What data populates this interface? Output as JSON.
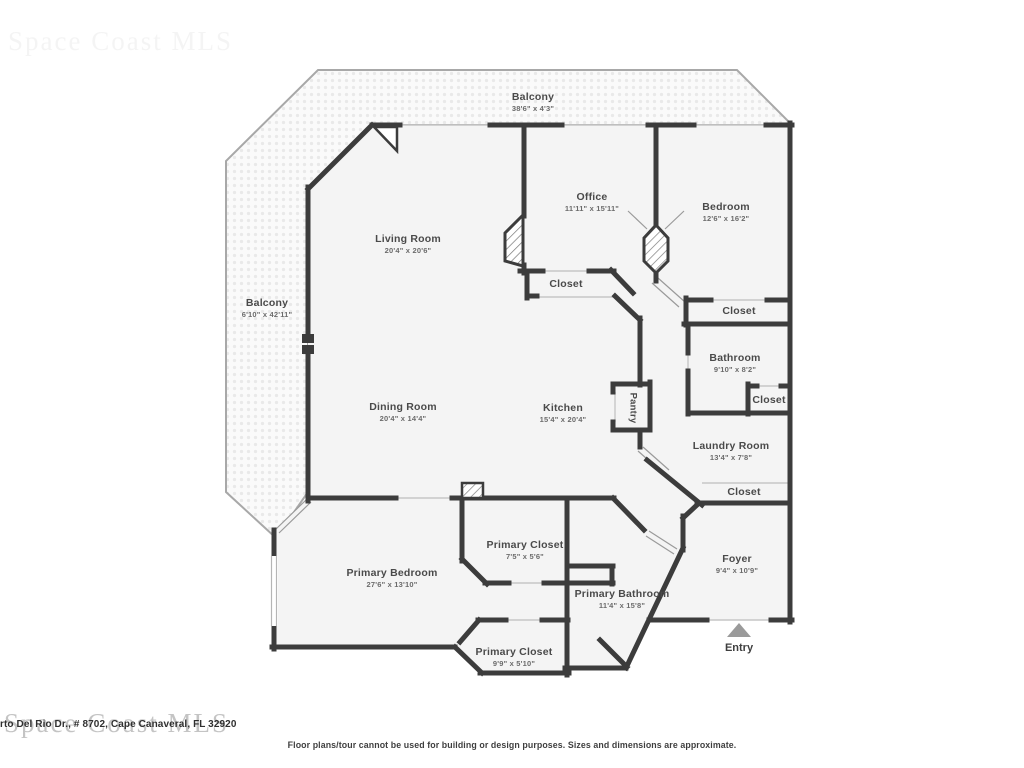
{
  "watermark": {
    "text": "Space Coast MLS"
  },
  "address": "rto Del Rio Dr., # 8702, Cape Canaveral, FL 32920",
  "disclaimer": "Floor plans/tour cannot be used for building or design purposes. Sizes and dimensions are approximate.",
  "entry": {
    "label": "Entry"
  },
  "colors": {
    "wall": "#3c3c3c",
    "floor": "#f4f4f4",
    "balcony_outline": "#a8a8a8",
    "opening_line": "#c6c6c6"
  },
  "rooms": [
    {
      "name": "Balcony",
      "dims": "38'6\" x 4'3\""
    },
    {
      "name": "Office",
      "dims": "11'11\" x 15'11\""
    },
    {
      "name": "Bedroom",
      "dims": "12'6\" x 16'2\""
    },
    {
      "name": "Living Room",
      "dims": "20'4\" x 20'6\""
    },
    {
      "name": "Balcony",
      "dims": "6'10\" x 42'11\""
    },
    {
      "name": "Closet"
    },
    {
      "name": "Closet"
    },
    {
      "name": "Bathroom",
      "dims": "9'10\" x 8'2\""
    },
    {
      "name": "Closet"
    },
    {
      "name": "Dining Room",
      "dims": "20'4\" x 14'4\""
    },
    {
      "name": "Kitchen",
      "dims": "15'4\" x 20'4\""
    },
    {
      "name": "Pantry"
    },
    {
      "name": "Laundry Room",
      "dims": "13'4\" x 7'8\""
    },
    {
      "name": "Closet"
    },
    {
      "name": "Primary Closet",
      "dims": "7'5\" x 5'6\""
    },
    {
      "name": "Foyer",
      "dims": "9'4\" x 10'9\""
    },
    {
      "name": "Primary Bedroom",
      "dims": "27'6\" x 13'10\""
    },
    {
      "name": "Primary Bathroom",
      "dims": "11'4\" x 15'8\""
    },
    {
      "name": "Primary Closet",
      "dims": "9'9\" x 5'10\""
    }
  ]
}
